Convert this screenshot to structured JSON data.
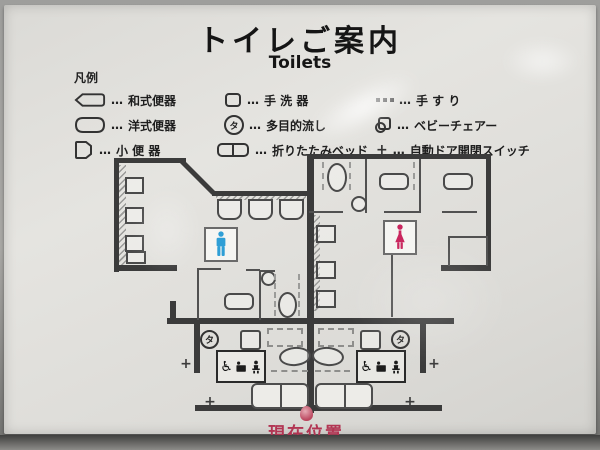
{
  "title": {
    "ja": "トイレご案内",
    "en": "Toilets"
  },
  "legend": {
    "heading": "凡例",
    "dots": "…",
    "columns": [
      {
        "items": [
          {
            "icon": "squat-toilet-icon",
            "label": "和式便器"
          },
          {
            "icon": "western-toilet-icon",
            "label": "洋式便器"
          },
          {
            "icon": "urinal-icon",
            "label": "小 便 器"
          }
        ]
      },
      {
        "items": [
          {
            "icon": "hand-basin-icon",
            "label": "手 洗 器"
          },
          {
            "icon": "multipurpose-sink-icon",
            "label": "多目的流し"
          },
          {
            "icon": "folding-bed-icon",
            "label": "折りたたみベッド"
          }
        ]
      },
      {
        "items": [
          {
            "icon": "handrail-icon",
            "label": "手 す り"
          },
          {
            "icon": "baby-chair-icon",
            "label": "ベビーチェアー"
          },
          {
            "icon": "door-switch-icon",
            "label": "自動ドア開閉スイッチ"
          }
        ]
      }
    ]
  },
  "map": {
    "multipurpose_symbol": "タ",
    "wheelchair_symbol": "♿",
    "switch_symbol": "+",
    "current_location": "現在位置",
    "colors": {
      "men_blue": "#2f9fd6",
      "women_red": "#c9265e",
      "wall": "#3b3b3b",
      "location_red": "#b23553",
      "marker_red": "#bc4860"
    }
  }
}
